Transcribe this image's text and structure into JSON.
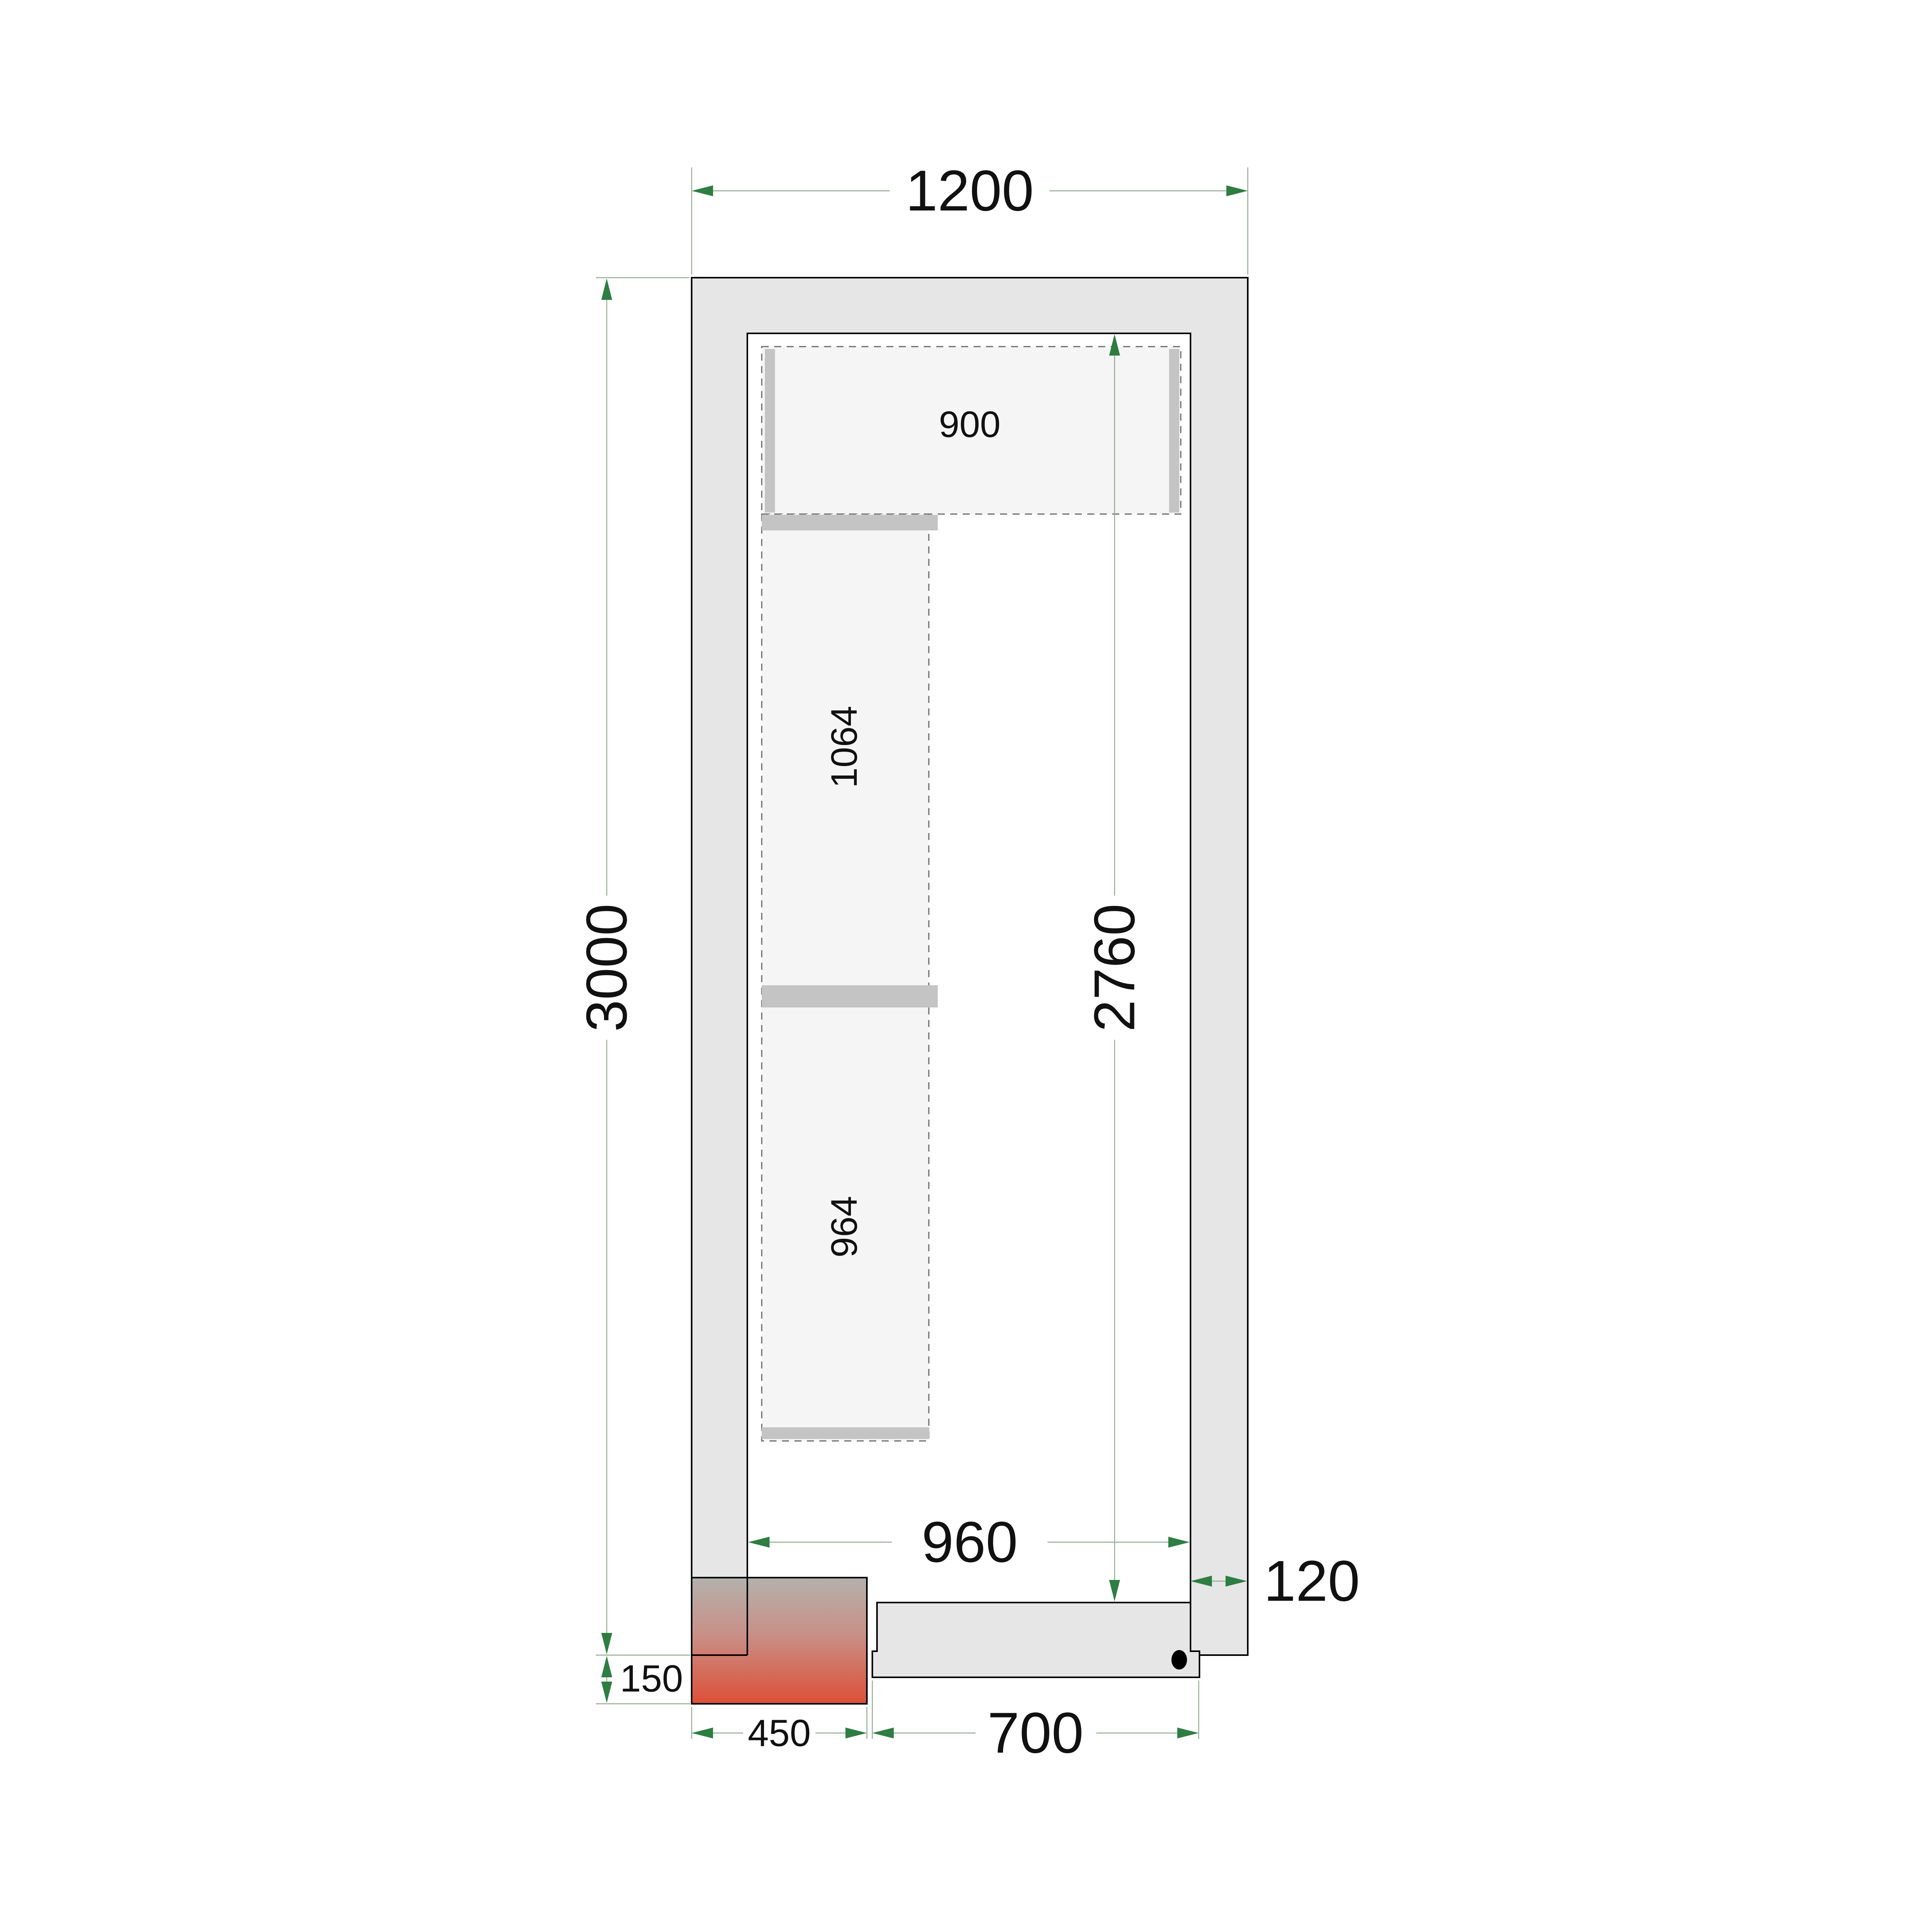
{
  "diagram": {
    "kind": "cold-room-floor-plan",
    "unit": "mm"
  },
  "labels": {
    "overall_width": "1200",
    "overall_depth": "3000",
    "interior_width": "960",
    "interior_depth": "2760",
    "wall_thickness": "120",
    "door_width": "700",
    "unit_width": "450",
    "unit_protrusion": "150",
    "top_shelf": "900",
    "left_shelf_upper": "1064",
    "left_shelf_lower": "964"
  },
  "colors": {
    "wall_fill": "#e6e6e6",
    "door_fill": "#e6e6e6",
    "shelf_fill": "#f5f5f5",
    "shelf_bar": "#c4c4c4",
    "outline": "#000000",
    "dim_line": "#92ab92",
    "dim_arrow": "#2e7d42",
    "unit_gradient_top": "#b4b1ac",
    "unit_gradient_mid": "#c89087",
    "unit_gradient_bottom": "#dd4f38"
  }
}
